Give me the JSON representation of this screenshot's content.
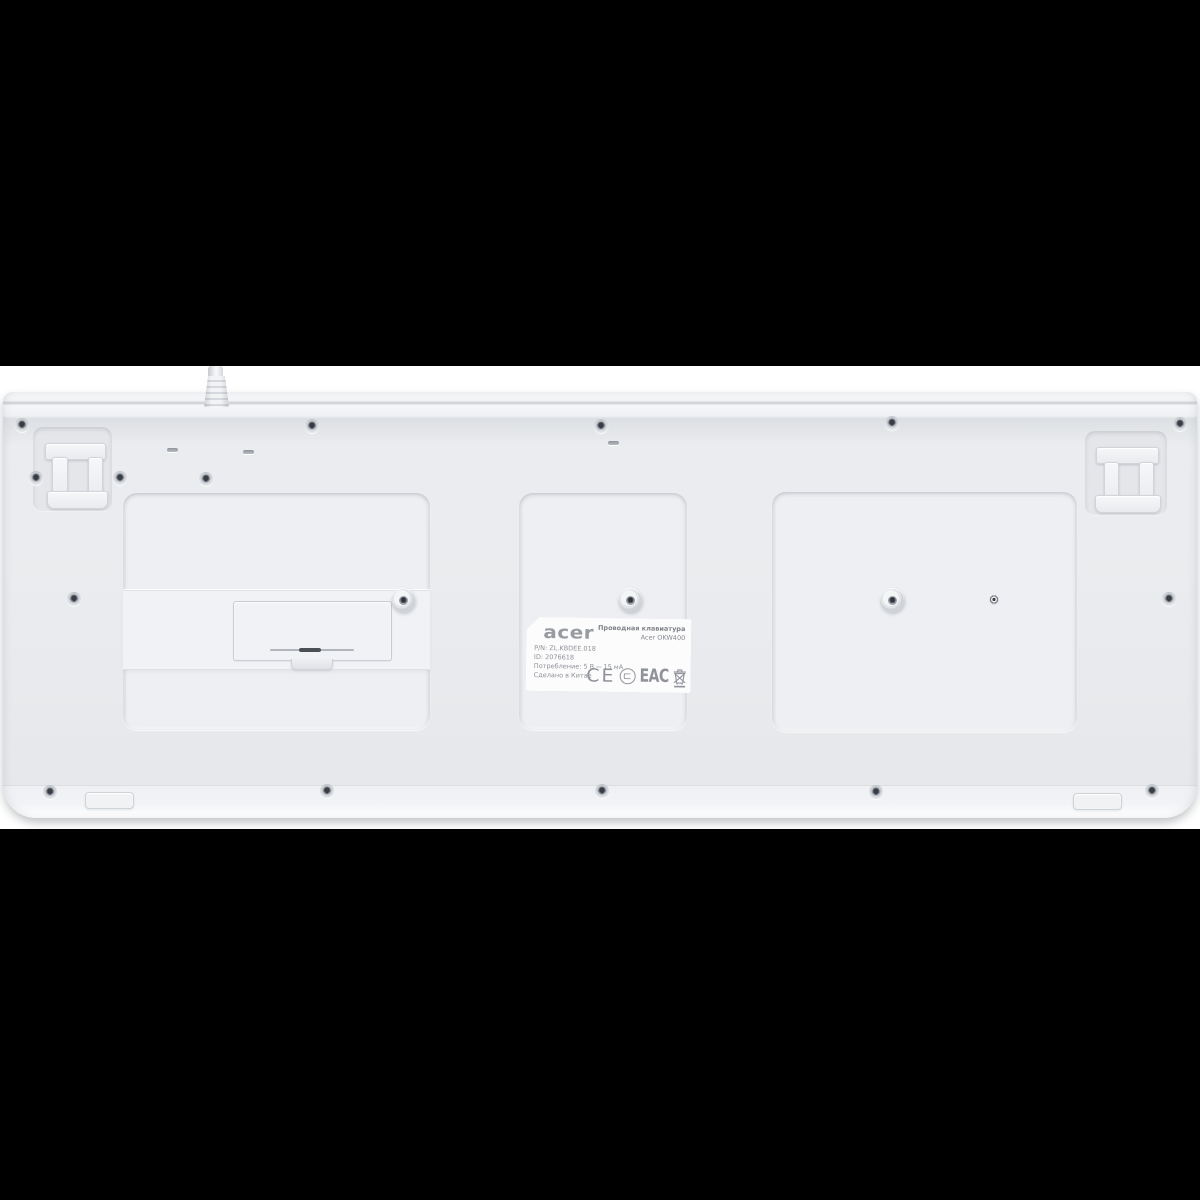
{
  "scene": {
    "background_color": "#000000",
    "photo_band_color": "#ffffff",
    "keyboard_body_color": "#e9ebee"
  },
  "label": {
    "brand_logo": "acer",
    "product_title": "Проводная клавиатура",
    "product_model": "Acer OKW400",
    "info_lines": [
      "P/N: ZL.KBDEE.018",
      "ID: 2076618",
      "Потребление: 5 В ⎓ 15 мА",
      "Сделано в Китае"
    ],
    "certification": {
      "ce": "CE",
      "eac": "EAC"
    },
    "icons": {
      "rostest": "rostest-certification-circle",
      "weee": "weee-crossed-out-bin"
    }
  }
}
